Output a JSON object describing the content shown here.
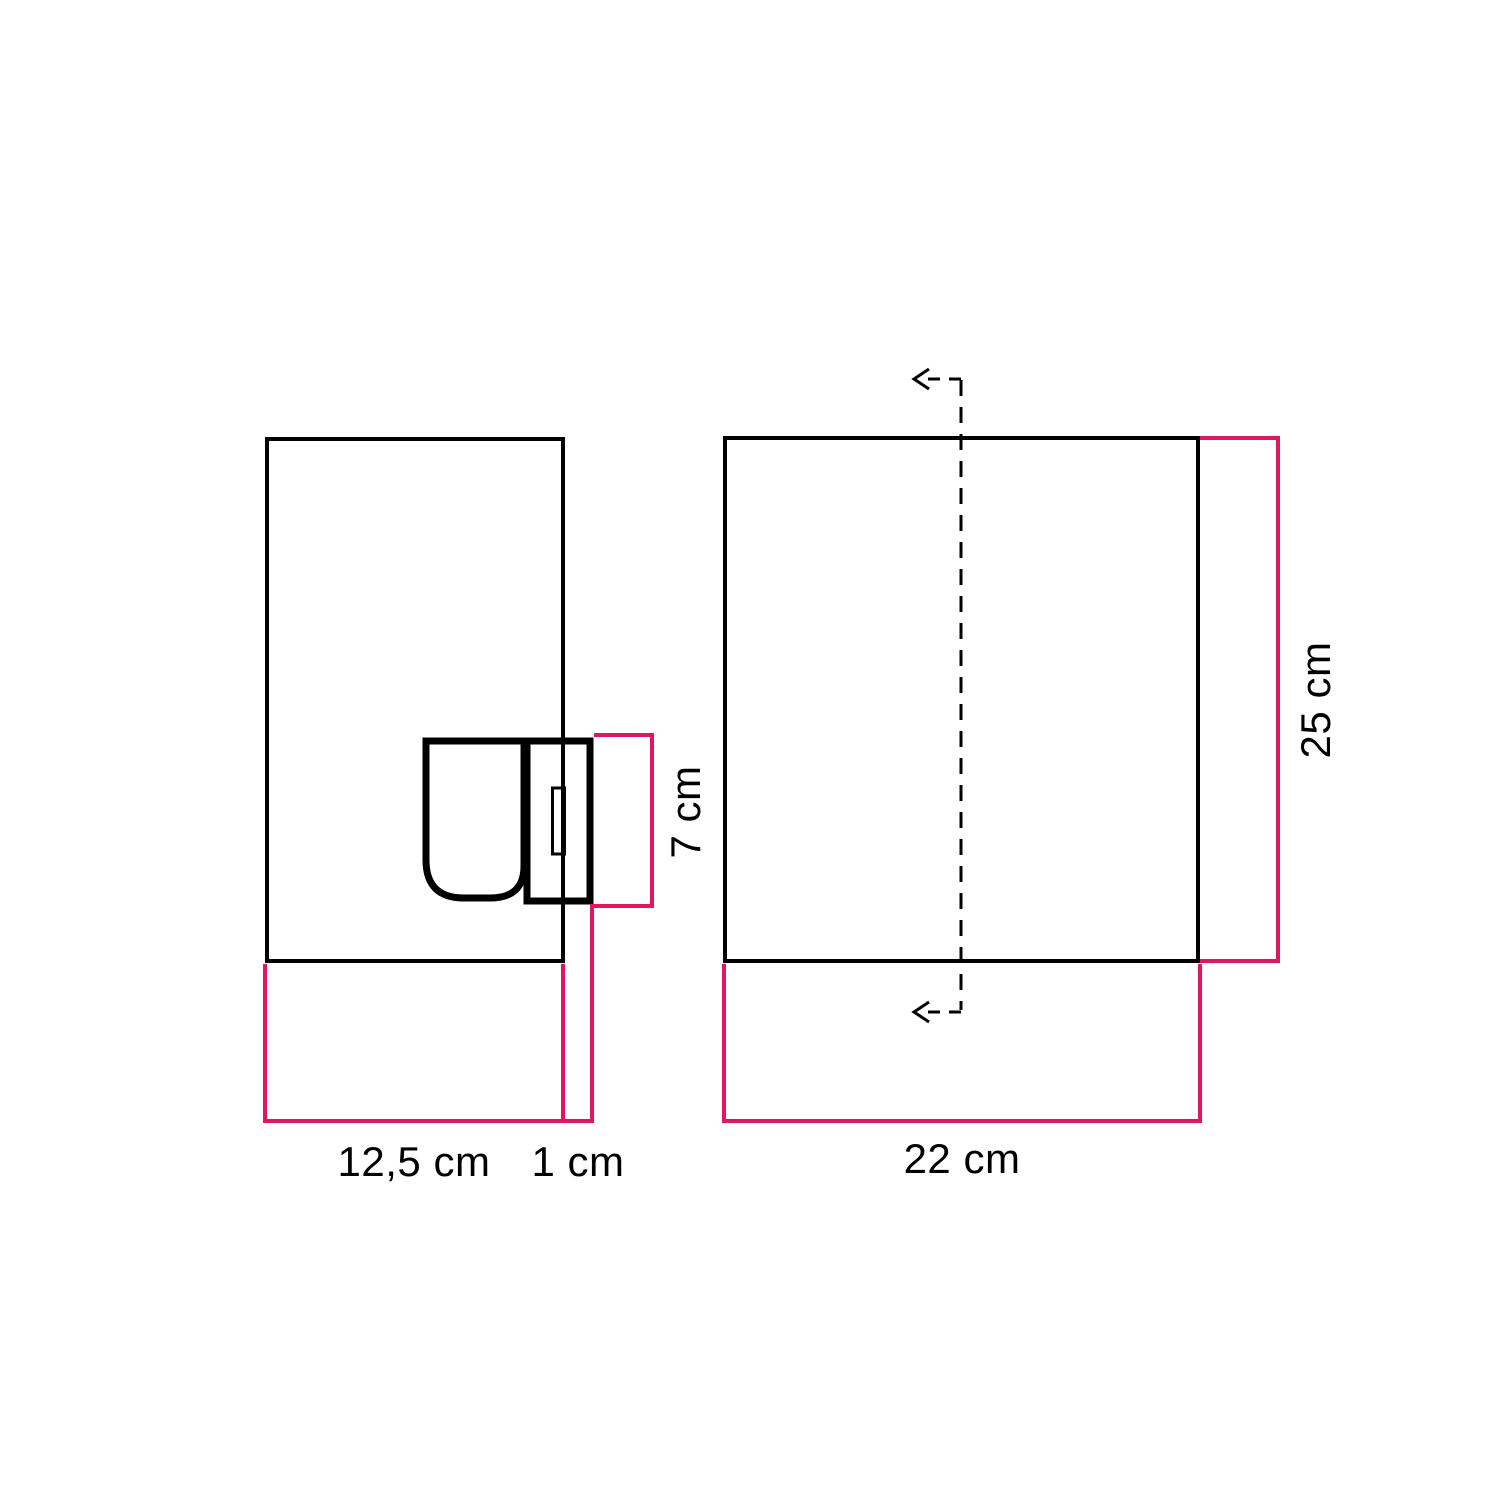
{
  "diagram": {
    "type": "dimension-drawing",
    "colors": {
      "accent": "#de1760",
      "line": "#000000",
      "background": "#ffffff"
    },
    "labels": {
      "side_width": "12,5 cm",
      "plate_offset": "1 cm",
      "holder_height": "7 cm",
      "front_width": "22 cm",
      "front_height": "25 cm"
    }
  }
}
